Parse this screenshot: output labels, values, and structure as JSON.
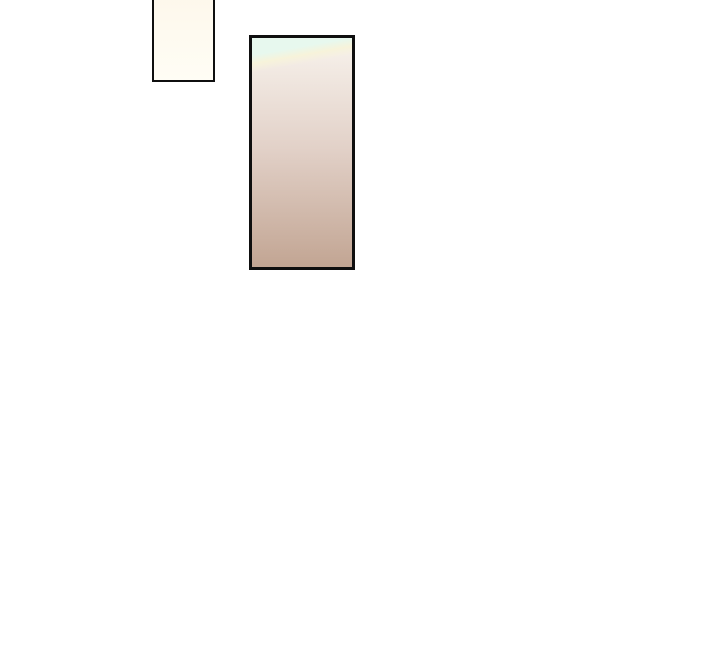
{
  "canvas": {
    "background_color": "#ffffff"
  },
  "panels": [
    {
      "name": "small-cream-panel",
      "description": "small bordered panel clipped at top of page",
      "border_color": "#0f0f0f",
      "fill_top": "#fdf7ea",
      "fill_bottom": "#fffdf5"
    },
    {
      "name": "large-gradient-panel",
      "description": "tall bordered panel with mint corner glow fading to dusty tan",
      "border_color": "#0f0f0f",
      "fill_top": "#f8f3ed",
      "fill_mid": "#e2d1c8",
      "fill_bottom": "#c2a593",
      "accent_top_left": "#e7f8ee",
      "glint": "#f7f3da"
    }
  ]
}
